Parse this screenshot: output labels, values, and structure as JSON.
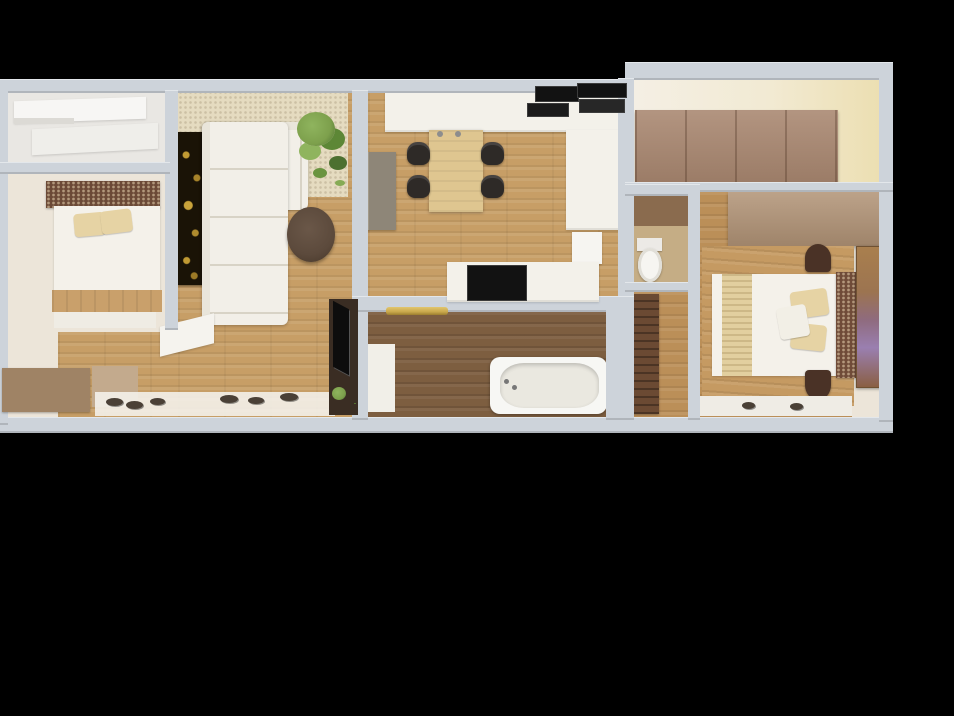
{
  "scene": {
    "title": "3D apartment floor plan - top-down render on black background",
    "background": "#000000"
  },
  "palette": {
    "bg": "#000000",
    "wall": "#cdd3da",
    "woodLight": "#c79e66",
    "woodMid": "#bb8f58",
    "woodDark": "#7d5e40",
    "cream": "#ece5d9",
    "closetFloor": "#e9e7e3",
    "rug": "#e5dbc0",
    "sofa": "#f2efe8",
    "sofaSeam": "#d8d3c6",
    "counter": "#f3f1ea",
    "appliance": "#121212",
    "tableWood": "#dfc690",
    "chair": "#2e2a27",
    "cabinetGray": "#8e8678",
    "headboard": "#6b4936",
    "headboard2": "#6f4b38",
    "pillow": "#e6d3a4",
    "bedWhite": "#f4f1ea",
    "dresser": "#9f8365",
    "mat": "#c3aa8d",
    "artDark": "#1a1306",
    "artGold": "#c09a33",
    "plantGreen": "#7da04c",
    "coffeeTable": "#5c4a3c",
    "tvBrown": "#3a2d23",
    "gold": "#c9a84c",
    "tub": "#f7f7f4",
    "toilet": "#f6f5f1",
    "wardrobeTan": "#a8866f",
    "wardrobeTan2": "#b19376",
    "hallCabinet": "#6b4a33",
    "wcTan": "#c5ad85",
    "wcWall": "#8a6b4e",
    "runner": "#e2cf9f",
    "wardrobePurple": "#9a7fb0",
    "shoe": "#4a4036"
  },
  "rooms": [
    {
      "id": "closet",
      "name": "built-in closet"
    },
    {
      "id": "bedroom-1",
      "name": "bedroom 1"
    },
    {
      "id": "living-room",
      "name": "living room"
    },
    {
      "id": "kitchen-dining",
      "name": "kitchen and dining room"
    },
    {
      "id": "bathroom",
      "name": "bathroom"
    },
    {
      "id": "wc",
      "name": "toilet room"
    },
    {
      "id": "hallway",
      "name": "hallway"
    },
    {
      "id": "dressing-room",
      "name": "dressing room with wardrobes"
    },
    {
      "id": "bedroom-2",
      "name": "bedroom 2"
    }
  ],
  "furniture": {
    "bedroom1": [
      "double-bed",
      "patterned-headboard",
      "two-pillows",
      "wood-footboard",
      "bench",
      "taupe-dresser",
      "entry-mat"
    ],
    "living": [
      "l-shaped-white-sofa",
      "dark-gold-wall-art",
      "shag-rug",
      "potted-plant",
      "round-coffee-table",
      "tv-cabinet",
      "shoe-mat-with-shoes",
      "open-door-leaf"
    ],
    "kitchen": [
      "white-counter-with-cooktop-and-oven",
      "right-counter",
      "dishwasher",
      "gray-tall-cabinet",
      "wood-dining-table",
      "four-black-chairs",
      "island-with-dark-top"
    ],
    "bathroom": [
      "bathtub",
      "gold-towel-rail",
      "white-appliance-block"
    ],
    "wc": [
      "toilet"
    ],
    "hallway": [
      "brown-tall-cabinet"
    ],
    "dressing": [
      "wardrobe-row"
    ],
    "bedroom2": [
      "double-bed",
      "beige-runner",
      "patterned-headboard",
      "pillows",
      "overhead-wardrobe",
      "two-round-nightstands",
      "purple-print-wardrobe-panel",
      "bedside-rug-with-slippers"
    ]
  }
}
